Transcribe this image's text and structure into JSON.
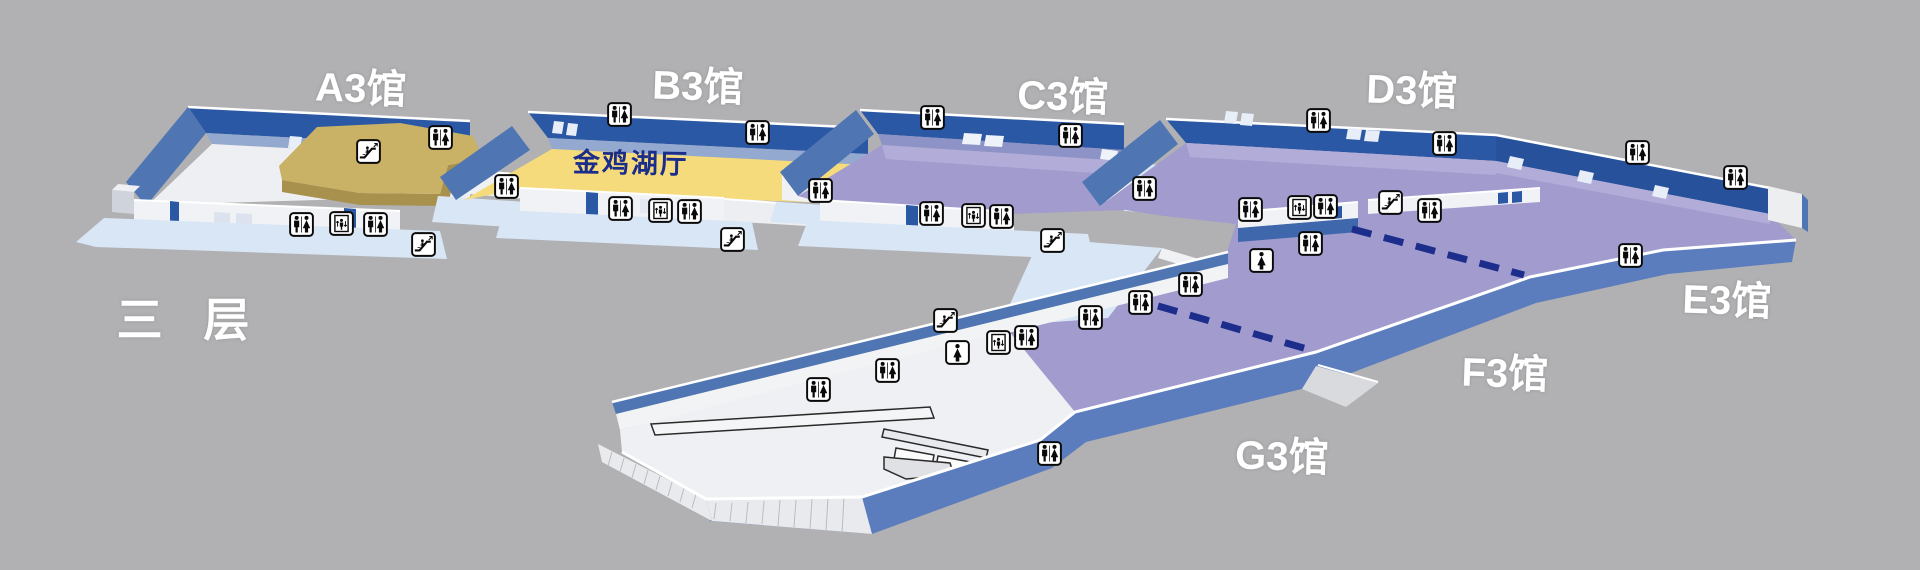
{
  "floor_label": "三 层",
  "halls": [
    {
      "id": "A3",
      "label": "A3馆"
    },
    {
      "id": "B3",
      "label": "B3馆"
    },
    {
      "id": "C3",
      "label": "C3馆"
    },
    {
      "id": "D3",
      "label": "D3馆"
    },
    {
      "id": "E3",
      "label": "E3馆"
    },
    {
      "id": "F3",
      "label": "F3馆"
    },
    {
      "id": "G3",
      "label": "G3馆"
    }
  ],
  "rooms": [
    {
      "id": "jinjihu",
      "label": "金鸡湖厅"
    }
  ],
  "colors": {
    "background": "#b1b1b3",
    "wall_dark_blue": "#2b58a4",
    "wall_medium_blue": "#4f76b2",
    "front_wall_blue": "#5b7cbd",
    "apron_light_blue": "#d9e6f5",
    "floor_white": "#eef0f3",
    "floor_yellow": "#f6db7c",
    "floor_purple": "#a19bce",
    "platform_tan": "#c9b166",
    "divider_navy": "#1c2d8c"
  },
  "icons": [
    {
      "type": "restroom",
      "x": 440,
      "y": 137
    },
    {
      "type": "restroom",
      "x": 301,
      "y": 224
    },
    {
      "type": "elevator",
      "x": 341,
      "y": 223
    },
    {
      "type": "restroom",
      "x": 375,
      "y": 224
    },
    {
      "type": "escalator",
      "x": 423,
      "y": 244
    },
    {
      "type": "escalator",
      "x": 368,
      "y": 151
    },
    {
      "type": "restroom",
      "x": 506,
      "y": 186
    },
    {
      "type": "restroom",
      "x": 619,
      "y": 114
    },
    {
      "type": "restroom",
      "x": 757,
      "y": 132
    },
    {
      "type": "restroom",
      "x": 620,
      "y": 208
    },
    {
      "type": "elevator",
      "x": 660,
      "y": 210
    },
    {
      "type": "restroom",
      "x": 689,
      "y": 211
    },
    {
      "type": "escalator",
      "x": 732,
      "y": 239
    },
    {
      "type": "restroom",
      "x": 820,
      "y": 190
    },
    {
      "type": "restroom",
      "x": 932,
      "y": 117
    },
    {
      "type": "restroom",
      "x": 1070,
      "y": 135
    },
    {
      "type": "restroom",
      "x": 931,
      "y": 213
    },
    {
      "type": "elevator",
      "x": 973,
      "y": 215
    },
    {
      "type": "restroom",
      "x": 1001,
      "y": 216
    },
    {
      "type": "escalator",
      "x": 1052,
      "y": 240
    },
    {
      "type": "restroom",
      "x": 1144,
      "y": 188
    },
    {
      "type": "restroom",
      "x": 1318,
      "y": 120
    },
    {
      "type": "restroom",
      "x": 1444,
      "y": 143
    },
    {
      "type": "restroom",
      "x": 1250,
      "y": 209
    },
    {
      "type": "elevator",
      "x": 1299,
      "y": 207
    },
    {
      "type": "restroom",
      "x": 1325,
      "y": 206
    },
    {
      "type": "escalator",
      "x": 1390,
      "y": 202
    },
    {
      "type": "restroom",
      "x": 1429,
      "y": 210
    },
    {
      "type": "woman",
      "x": 1261,
      "y": 260
    },
    {
      "type": "restroom",
      "x": 1310,
      "y": 243
    },
    {
      "type": "restroom",
      "x": 1637,
      "y": 152
    },
    {
      "type": "restroom",
      "x": 1735,
      "y": 177
    },
    {
      "type": "restroom",
      "x": 1630,
      "y": 255
    },
    {
      "type": "restroom",
      "x": 1190,
      "y": 284
    },
    {
      "type": "restroom",
      "x": 1140,
      "y": 302
    },
    {
      "type": "restroom",
      "x": 1090,
      "y": 317
    },
    {
      "type": "restroom",
      "x": 1026,
      "y": 337
    },
    {
      "type": "elevator",
      "x": 998,
      "y": 342
    },
    {
      "type": "escalator",
      "x": 945,
      "y": 320
    },
    {
      "type": "woman",
      "x": 957,
      "y": 352
    },
    {
      "type": "restroom",
      "x": 887,
      "y": 370
    },
    {
      "type": "restroom",
      "x": 818,
      "y": 389
    },
    {
      "type": "restroom",
      "x": 1049,
      "y": 453
    }
  ],
  "dividers": [
    {
      "x1": 1352,
      "y1": 229,
      "x2": 1524,
      "y2": 275
    },
    {
      "x1": 1158,
      "y1": 306,
      "x2": 1314,
      "y2": 351
    }
  ]
}
